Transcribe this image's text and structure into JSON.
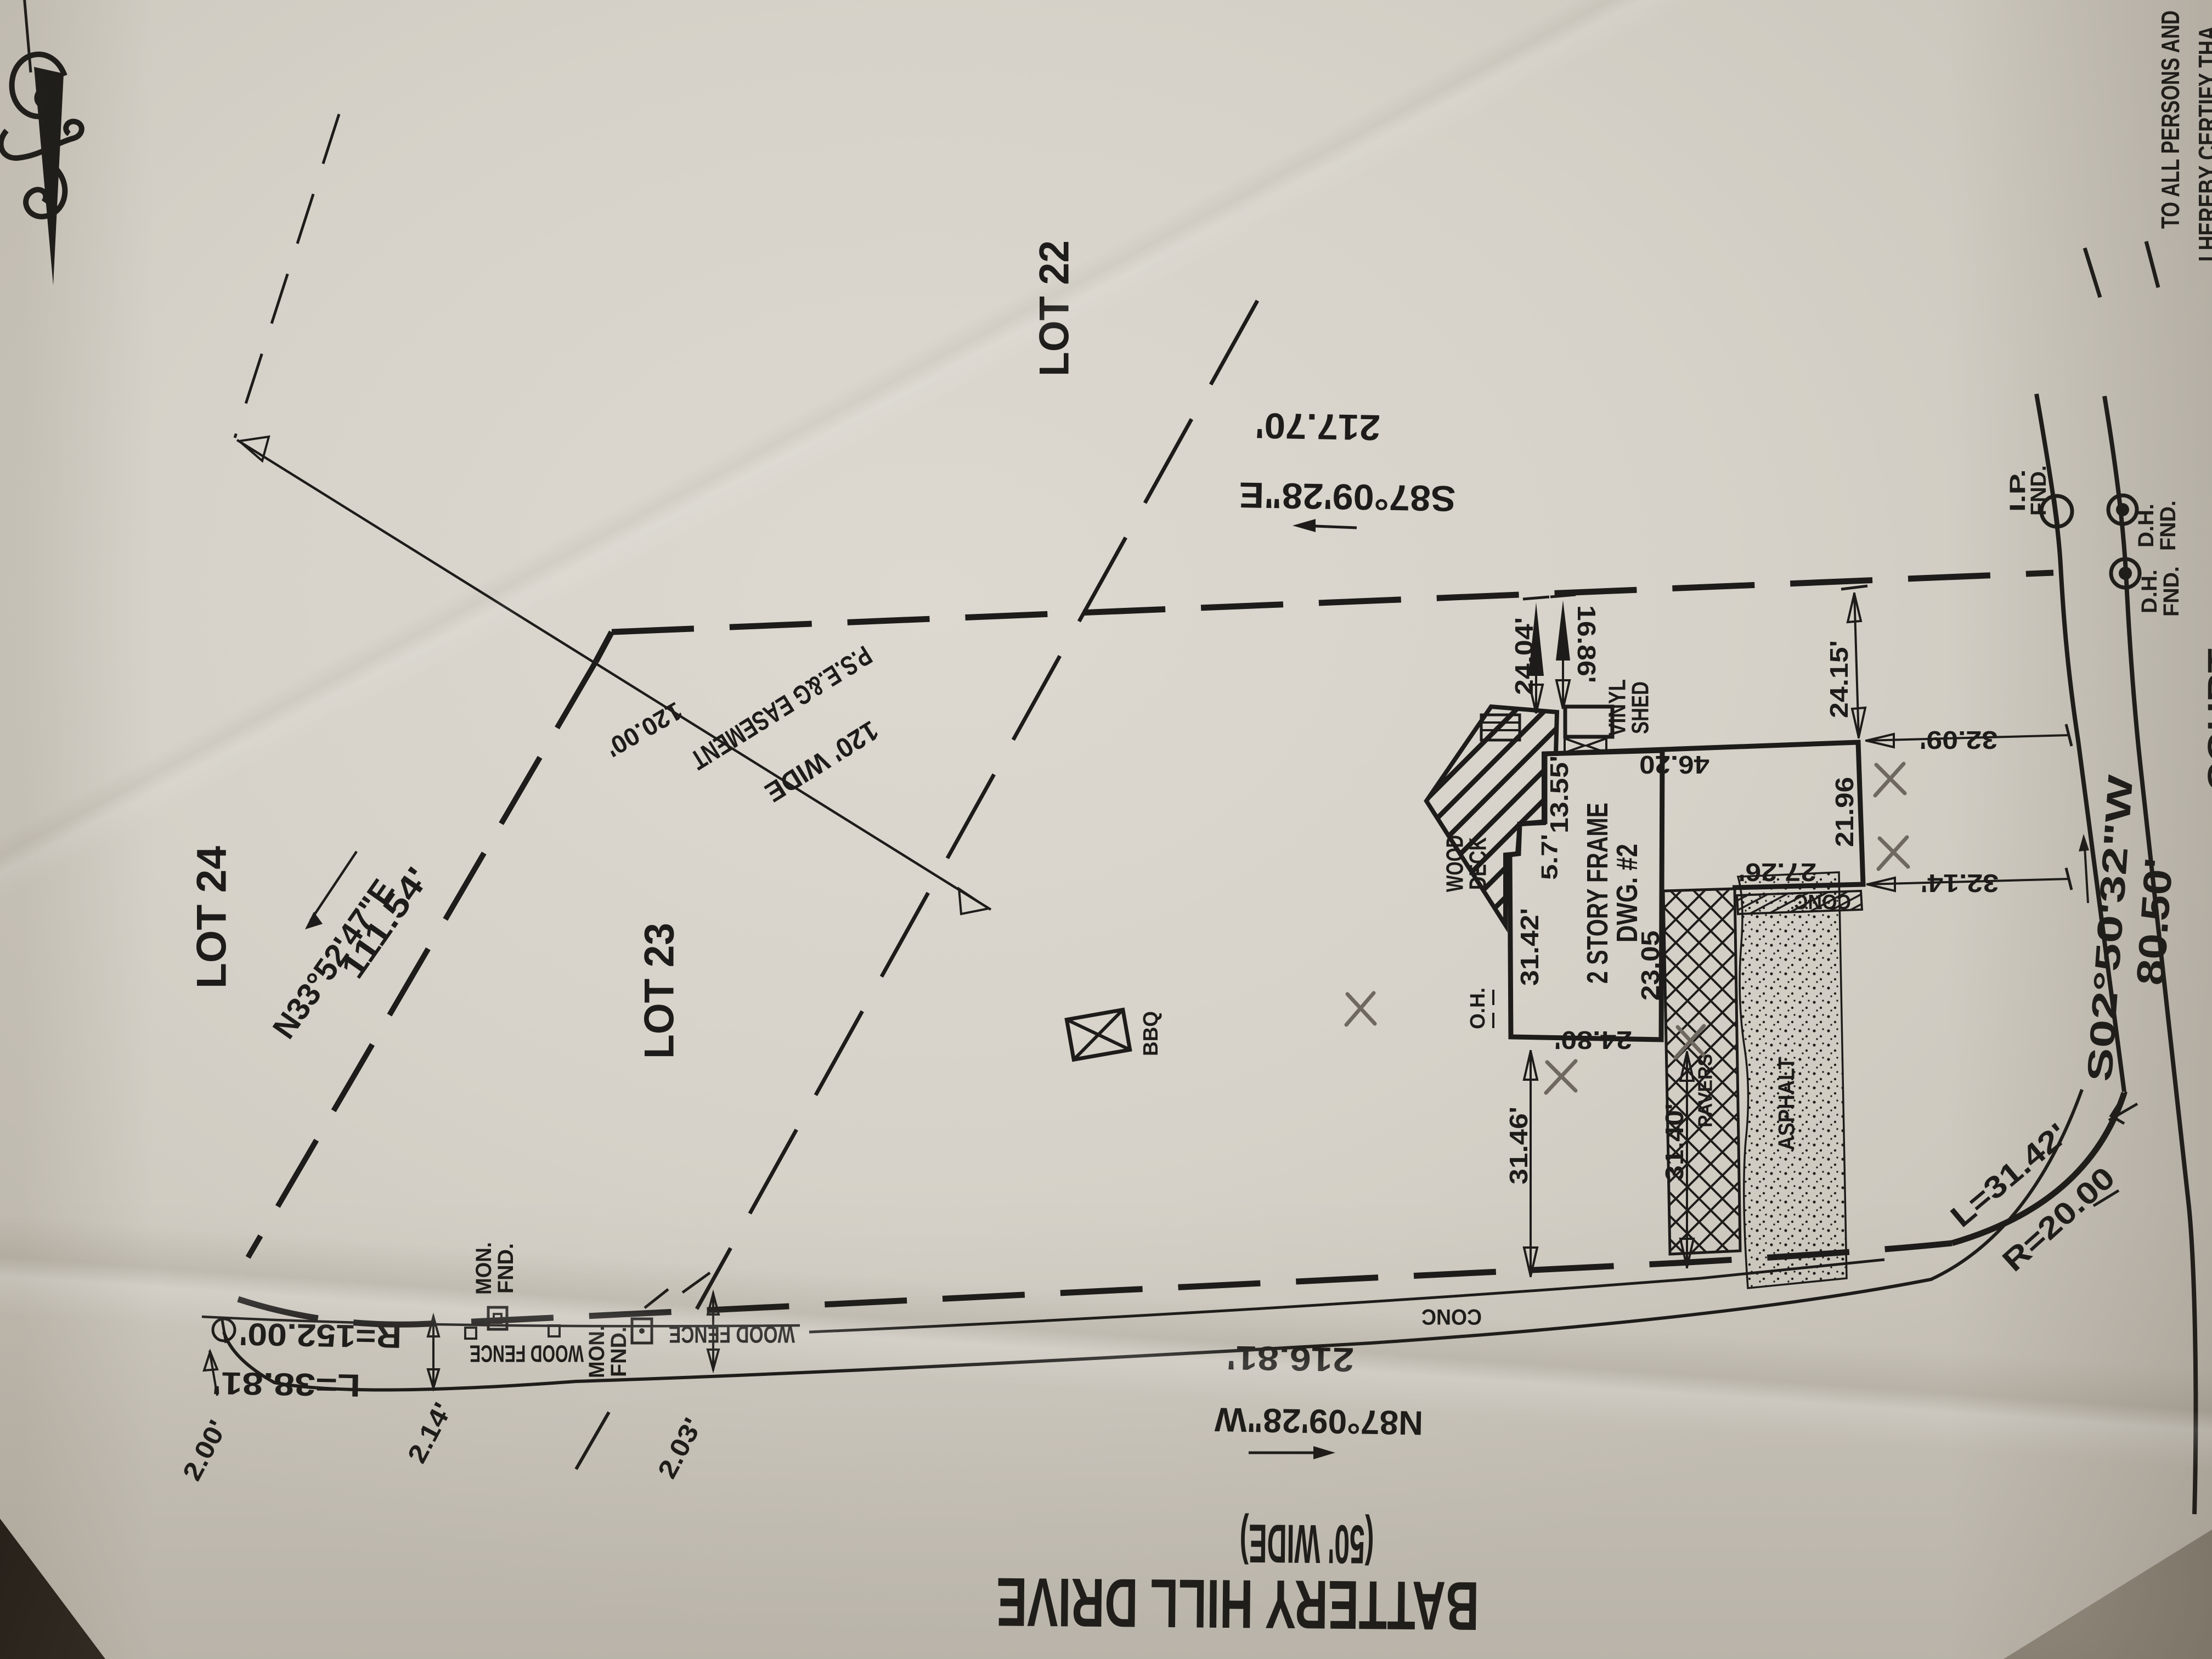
{
  "certification": {
    "line1": "TO ALL PERSONS AND",
    "line2": "I HEREBY CERTIFY THA"
  },
  "lots": {
    "lot_22": "LOT 22",
    "lot_23": "LOT 23",
    "lot_24": "LOT 24"
  },
  "street": {
    "name": "BATTERY HILL DRIVE",
    "width_note": "(50' WIDE)",
    "side_street_partial": "COURT"
  },
  "bearings": {
    "rear_bearing": "S87°09'28\"E",
    "rear_distance": "217.70'",
    "front_bearing": "N87°09'28\"W",
    "front_distance": "216.81'",
    "right_bearing": "S02°50'32\"W",
    "right_distance": "80.50'",
    "left_bearing": "N33°52'47\"E",
    "left_distance": "111.54'"
  },
  "curves": {
    "corner_length": "L=31.42'",
    "corner_radius": "R=20.00",
    "frontage_length": "L=38.81'",
    "frontage_radius": "R=152.00'"
  },
  "easement": {
    "width_label": "120' WIDE",
    "name": "P.S.E.&G EASEMENT",
    "segment_length": "120.00'"
  },
  "structures": {
    "dwelling_line1": "2 STORY FRAME",
    "dwelling_line2": "DWG. #2",
    "deck_line1": "WOOD",
    "deck_line2": "DECK",
    "shed_line1": "VINYL",
    "shed_line2": "SHED",
    "bbq": "BBQ",
    "overhang": "O.H."
  },
  "surfaces": {
    "sidewalk": "CONC",
    "patio": "CONC",
    "pavers": "PAVERS",
    "asphalt": "ASPHALT"
  },
  "monuments": {
    "ip_line1": "I.P.",
    "ip_line2": "FND.",
    "dh1_line1": "D.H.",
    "dh1_line2": "FND.",
    "dh2_line1": "D.H.",
    "dh2_line2": "FND.",
    "mon1_line1": "MON.",
    "mon1_line2": "FND.",
    "mon2_line1": "MON.",
    "mon2_line2": "FND."
  },
  "fences": {
    "wood_fence_left": "WOOD FENCE",
    "wood_fence_right": "WOOD FENCE"
  },
  "dimensions": {
    "rear_to_deck": "24.04'",
    "rear_to_shed": "16.86'",
    "house_east_upper": "13.55'",
    "house_jog": "5.7'",
    "fence_north": "46.20",
    "house_west": "31.42'",
    "house_south": "24.80'",
    "house_east_lower": "23.05",
    "rear_to_fence": "24.15'",
    "fence_to_line_upper": "32.09'",
    "fence_east": "21.96",
    "fence_to_line_lower": "32.14'",
    "fence_south": "27.26'",
    "house_to_street_west": "31.46'",
    "house_to_street_east": "31.40'",
    "offset_corner": "2.00'",
    "offset_mid": "2.14'",
    "offset_right": "2.03'"
  },
  "icons": {
    "north_arrow": "ornate-north-arrow",
    "bbq_symbol": "crossed-box-bbq",
    "monument_symbols": "survey-monument-marks"
  },
  "colors": {
    "ink": "#1d1c1a",
    "paper": "#d6d2c9",
    "pencil_mark": "#6e6860",
    "countertop": "#262019",
    "marble": "#7b7467"
  }
}
